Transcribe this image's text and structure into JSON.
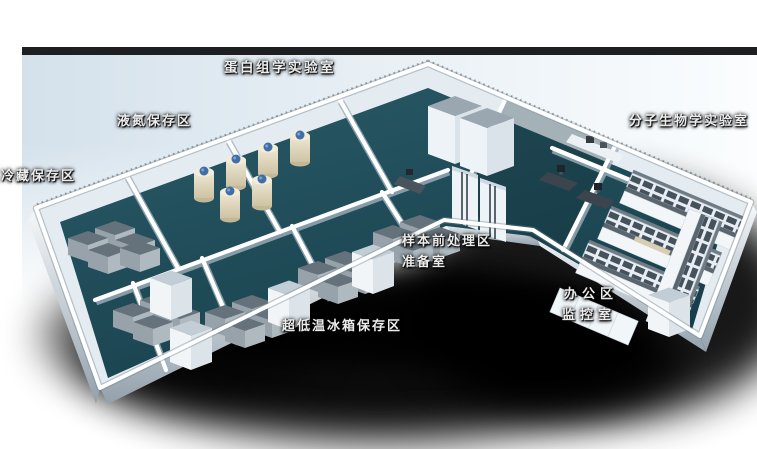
{
  "scene": {
    "kind": "isometric-laboratory-floorplan",
    "palette": {
      "background_panel": "#d9e5ee",
      "panel_top_edge": "#0c0e10",
      "wall": "#e4ecf2",
      "wall_highlight": "#ffffff",
      "floor_teal": "#1e4d5a",
      "ground_shadow": "#000000",
      "freezer_gray": "#8d99a2",
      "tank_cream": "#e8e0c6",
      "tank_cap_blue": "#3f6ea8",
      "bench_shelf_dark": "#46525b",
      "bench_counter_tan": "#d8cfb2",
      "desk_dark": "#3c454d"
    }
  },
  "labels": [
    {
      "name": "proteomics-lab",
      "text": "蛋白组学实验室"
    },
    {
      "name": "liquid-nitrogen-storage",
      "text": "液氮保存区"
    },
    {
      "name": "cold-storage",
      "text": "冷藏保存区"
    },
    {
      "name": "molecular-biology-lab",
      "text": "分子生物学实验室"
    },
    {
      "name": "sample-pretreatment-area",
      "text": "样本前处理区"
    },
    {
      "name": "preparation-room",
      "text": "准备室"
    },
    {
      "name": "office-area",
      "text": "办公区"
    },
    {
      "name": "monitoring-room",
      "text": "监控室"
    },
    {
      "name": "ult-freezer-storage",
      "text": "超低温冰箱保存区"
    }
  ]
}
